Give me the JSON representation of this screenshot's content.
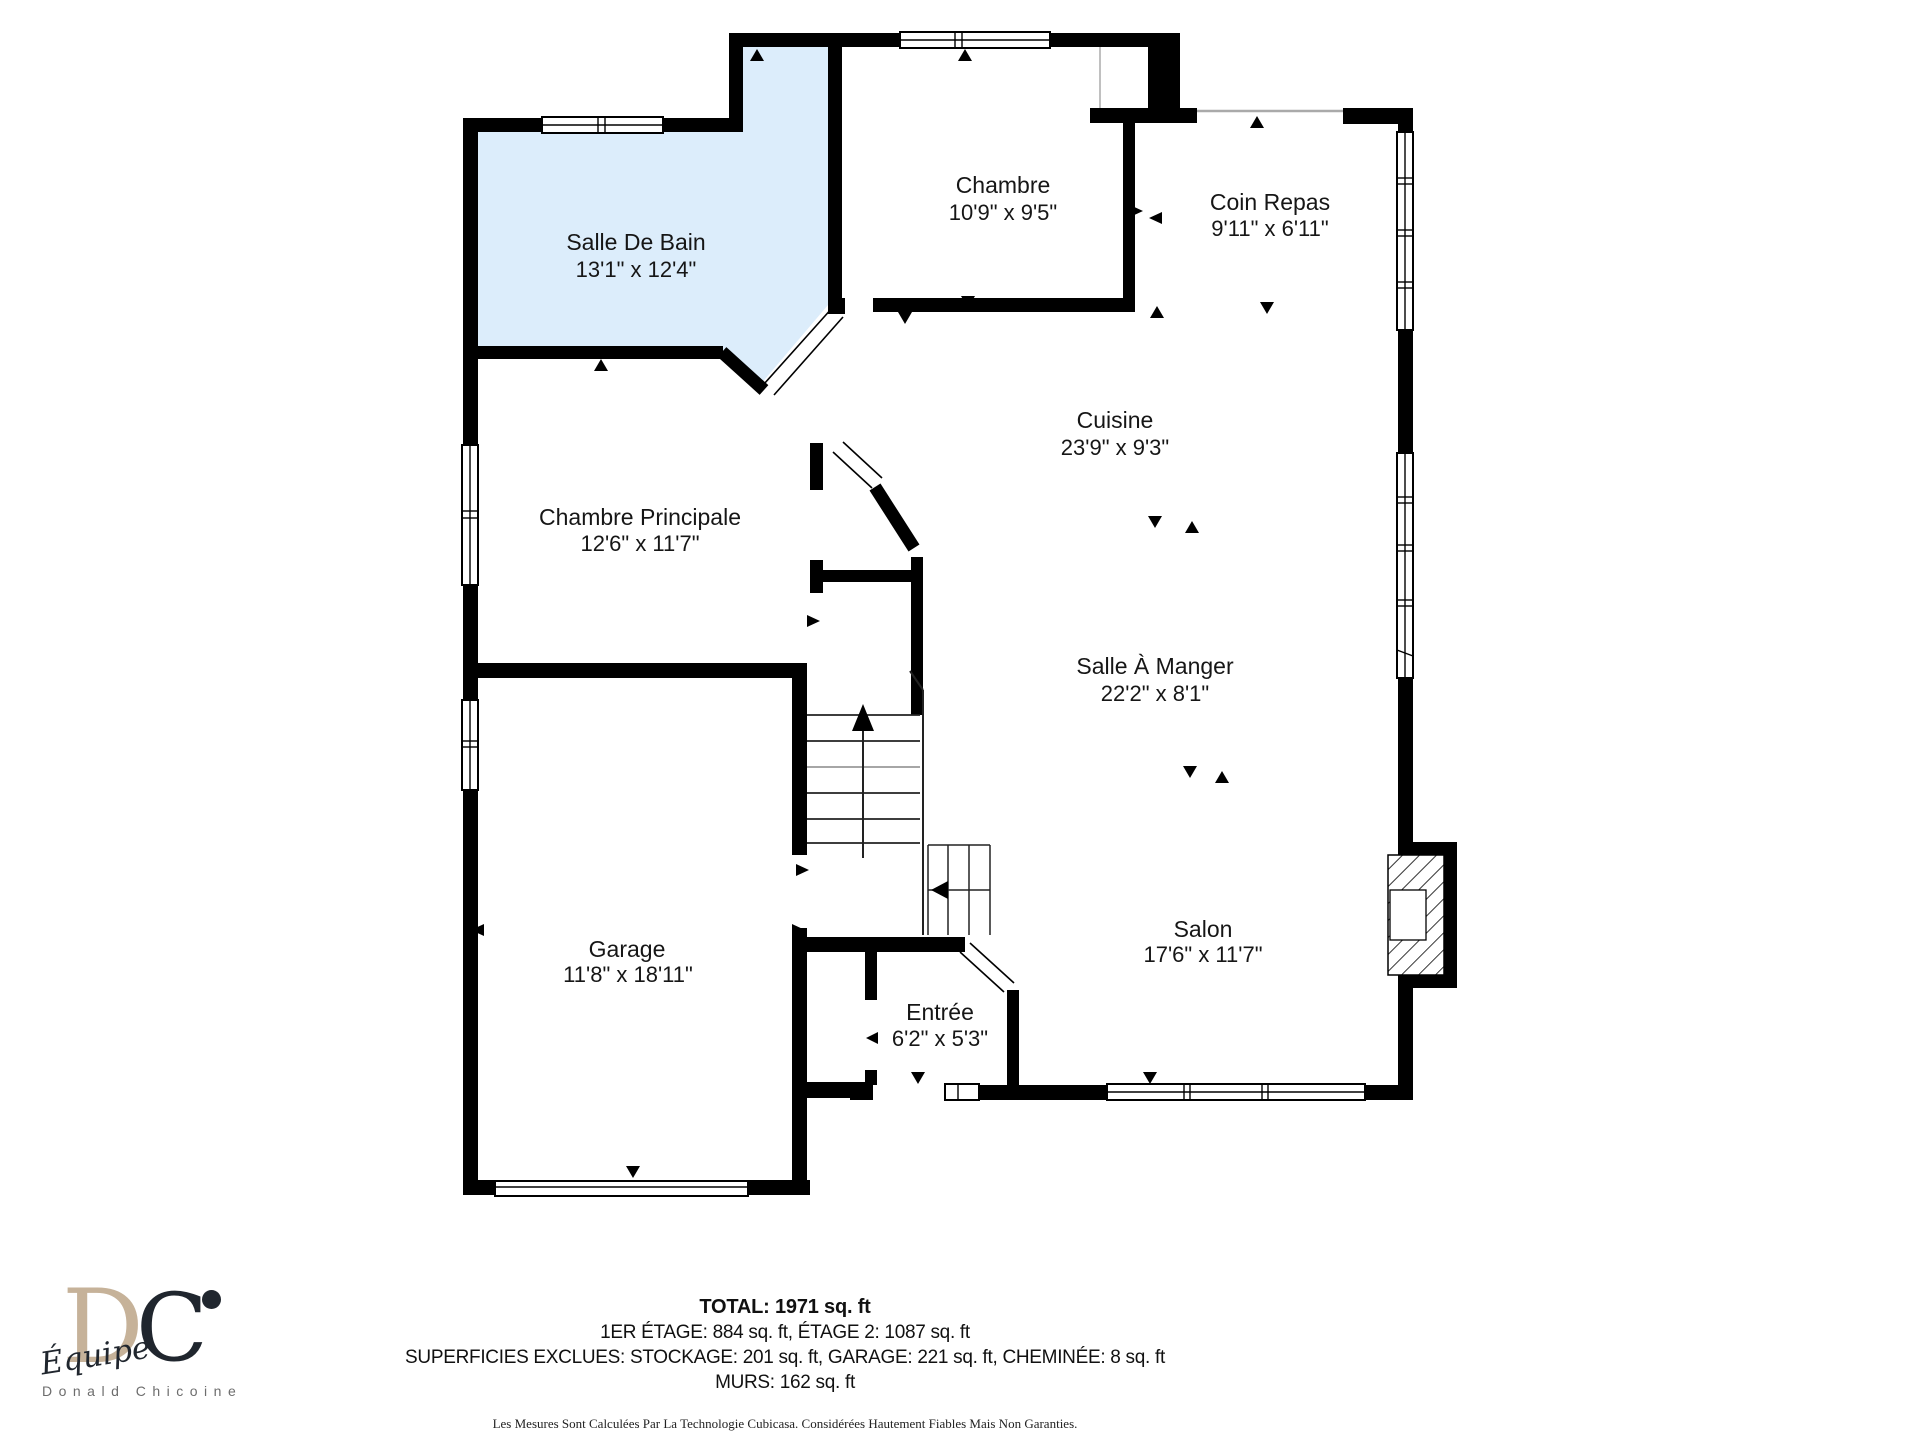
{
  "plan": {
    "rooms": [
      {
        "id": "salle-de-bain",
        "name": "Salle De Bain",
        "dims": "13'1\" x 12'4\""
      },
      {
        "id": "chambre",
        "name": "Chambre",
        "dims": "10'9\" x 9'5\""
      },
      {
        "id": "coin-repas",
        "name": "Coin Repas",
        "dims": "9'11\" x 6'11\""
      },
      {
        "id": "cuisine",
        "name": "Cuisine",
        "dims": "23'9\" x 9'3\""
      },
      {
        "id": "chambre-principale",
        "name": "Chambre Principale",
        "dims": "12'6\" x 11'7\""
      },
      {
        "id": "salle-a-manger",
        "name": "Salle À Manger",
        "dims": "22'2\" x 8'1\""
      },
      {
        "id": "garage",
        "name": "Garage",
        "dims": "11'8\" x 18'11\""
      },
      {
        "id": "salon",
        "name": "Salon",
        "dims": "17'6\" x 11'7\""
      },
      {
        "id": "entree",
        "name": "Entrée",
        "dims": "6'2\" x 5'3\""
      }
    ],
    "colors": {
      "bathroom_fill": "#DCEDFB",
      "wall": "#000000"
    }
  },
  "footer": {
    "total": "TOTAL: 1971 sq. ft",
    "floors": "1ER ÉTAGE: 884 sq. ft, ÉTAGE 2: 1087 sq. ft",
    "exclusions": "SUPERFICIES EXCLUES: STOCKAGE: 201 sq. ft, GARAGE: 221 sq. ft, CHEMINÉE: 8 sq. ft",
    "walls": "MURS: 162 sq. ft",
    "disclaimer": "Les Mesures Sont Calculées Par La Technologie Cubicasa. Considérées Hautement Fiables Mais Non Garanties."
  },
  "logo": {
    "initial_d": "D",
    "initial_c": "C",
    "team": "Équipe",
    "agent": "Donald Chicoine",
    "beige": "#C6B299",
    "dark": "#20262E"
  }
}
